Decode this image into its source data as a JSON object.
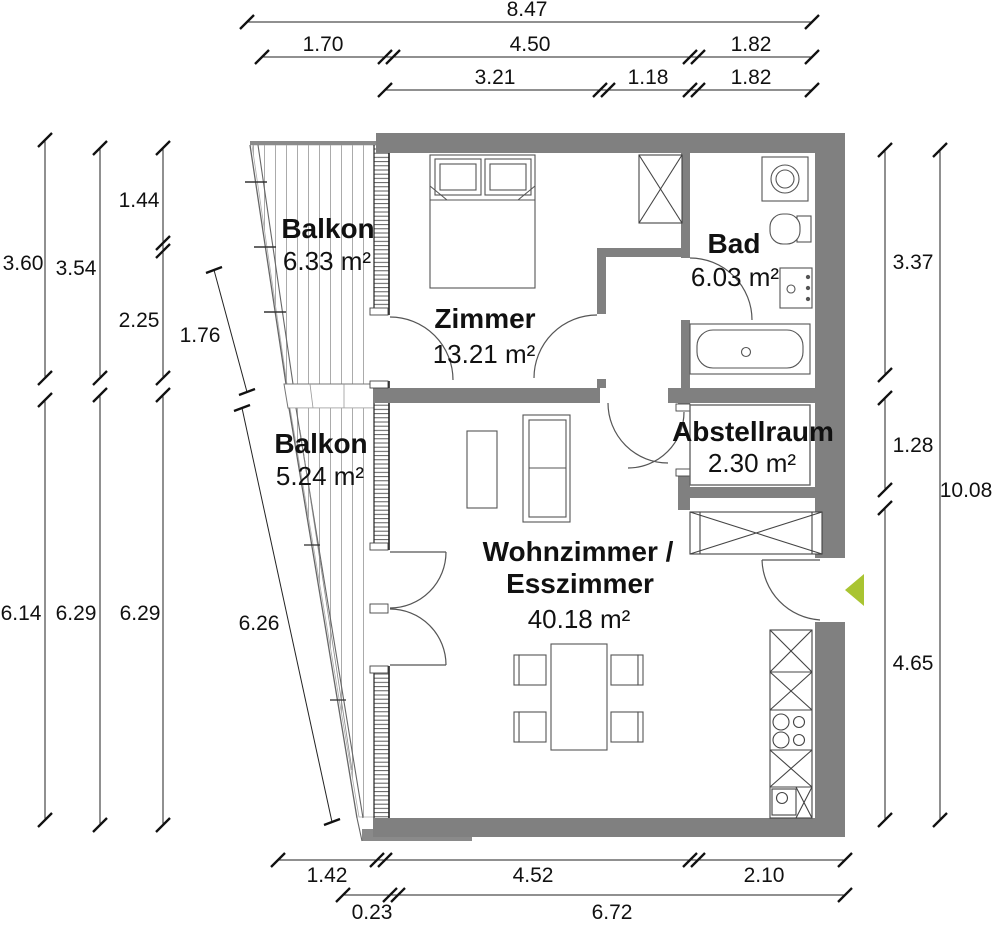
{
  "title": "Wohnung Grundriss (floor plan)",
  "rooms": {
    "balkon_top": {
      "name": "Balkon",
      "area": "6.33 m²"
    },
    "zimmer": {
      "name": "Zimmer",
      "area": "13.21 m²"
    },
    "bad": {
      "name": "Bad",
      "area": "6.03 m²"
    },
    "balkon_bottom": {
      "name": "Balkon",
      "area": "5.24 m²"
    },
    "abstellraum": {
      "name": "Abstellraum",
      "area": "2.30 m²"
    },
    "wohnzimmer": {
      "name_line1": "Wohnzimmer /",
      "name_line2": "Esszimmer",
      "area": "40.18 m²"
    }
  },
  "dimensions": {
    "top": {
      "total": "8.47",
      "row2": [
        "1.70",
        "4.50",
        "1.82"
      ],
      "row3": [
        "3.21",
        "1.18",
        "1.82"
      ]
    },
    "left": {
      "col1_top": "3.60",
      "col2_top": "3.54",
      "col3_top": [
        "1.44",
        "2.25"
      ],
      "diag_top": "1.76",
      "col1_bottom": "6.14",
      "col2_bottom": "6.29",
      "col3_bottom": "6.29",
      "diag_bottom": "6.26"
    },
    "right": {
      "seg1": "3.37",
      "seg2": "1.28",
      "total": "10.08",
      "seg3": "4.65"
    },
    "bottom": {
      "row1": [
        "1.42",
        "4.52",
        "2.10"
      ],
      "row2": [
        "0.23",
        "6.72"
      ]
    }
  },
  "colors": {
    "wall": "#808080",
    "entrance_arrow": "#a9c431"
  }
}
